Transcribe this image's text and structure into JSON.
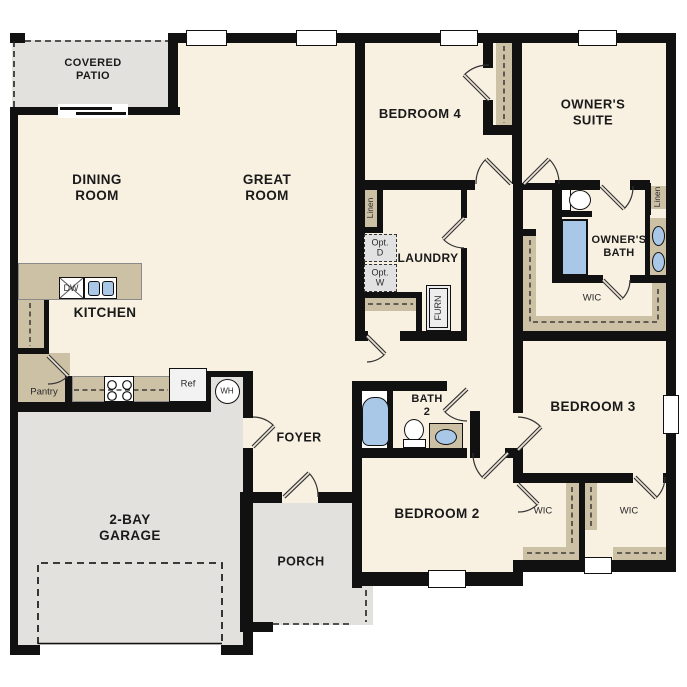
{
  "fp": {
    "title": "single-story-floor-plan",
    "rooms": {
      "patio": {
        "l1": "COVERED",
        "l2": "PATIO"
      },
      "dining": {
        "l1": "DINING",
        "l2": "ROOM"
      },
      "great": {
        "l1": "GREAT",
        "l2": "ROOM"
      },
      "kitchen": "KITCHEN",
      "garage": {
        "l1": "2-BAY",
        "l2": "GARAGE"
      },
      "foyer": "FOYER",
      "porch": "PORCH",
      "bedroom2": "BEDROOM 2",
      "bedroom3": "BEDROOM 3",
      "bedroom4": "BEDROOM 4",
      "owners_suite": {
        "l1": "OWNER'S",
        "l2": "SUITE"
      },
      "owners_bath": {
        "l1": "OWNER'S",
        "l2": "BATH"
      },
      "bath2": {
        "l1": "BATH",
        "l2": "2"
      },
      "laundry": "LAUNDRY"
    },
    "closets": {
      "pantry": "Pantry",
      "linen_hall": "Linen",
      "linen_owner": "Linen",
      "wic_owner": "WIC",
      "wic_bed2": "WIC",
      "wic_bed3": "WIC"
    },
    "appliances": {
      "dw": "DW",
      "ref": "Ref",
      "wh": "WH",
      "furn": "FURN",
      "opt_d_l1": "Opt.",
      "opt_d_l2": "D",
      "opt_w_l1": "Opt.",
      "opt_w_l2": "W"
    },
    "colors": {
      "wall": "#111111",
      "floor": "#f8f0e1",
      "outdoor": "#e3e1de",
      "cabinet": "#cdc1a5",
      "fixture_blue": "#a9c7e6",
      "appliance": "#e2e2e2"
    }
  }
}
